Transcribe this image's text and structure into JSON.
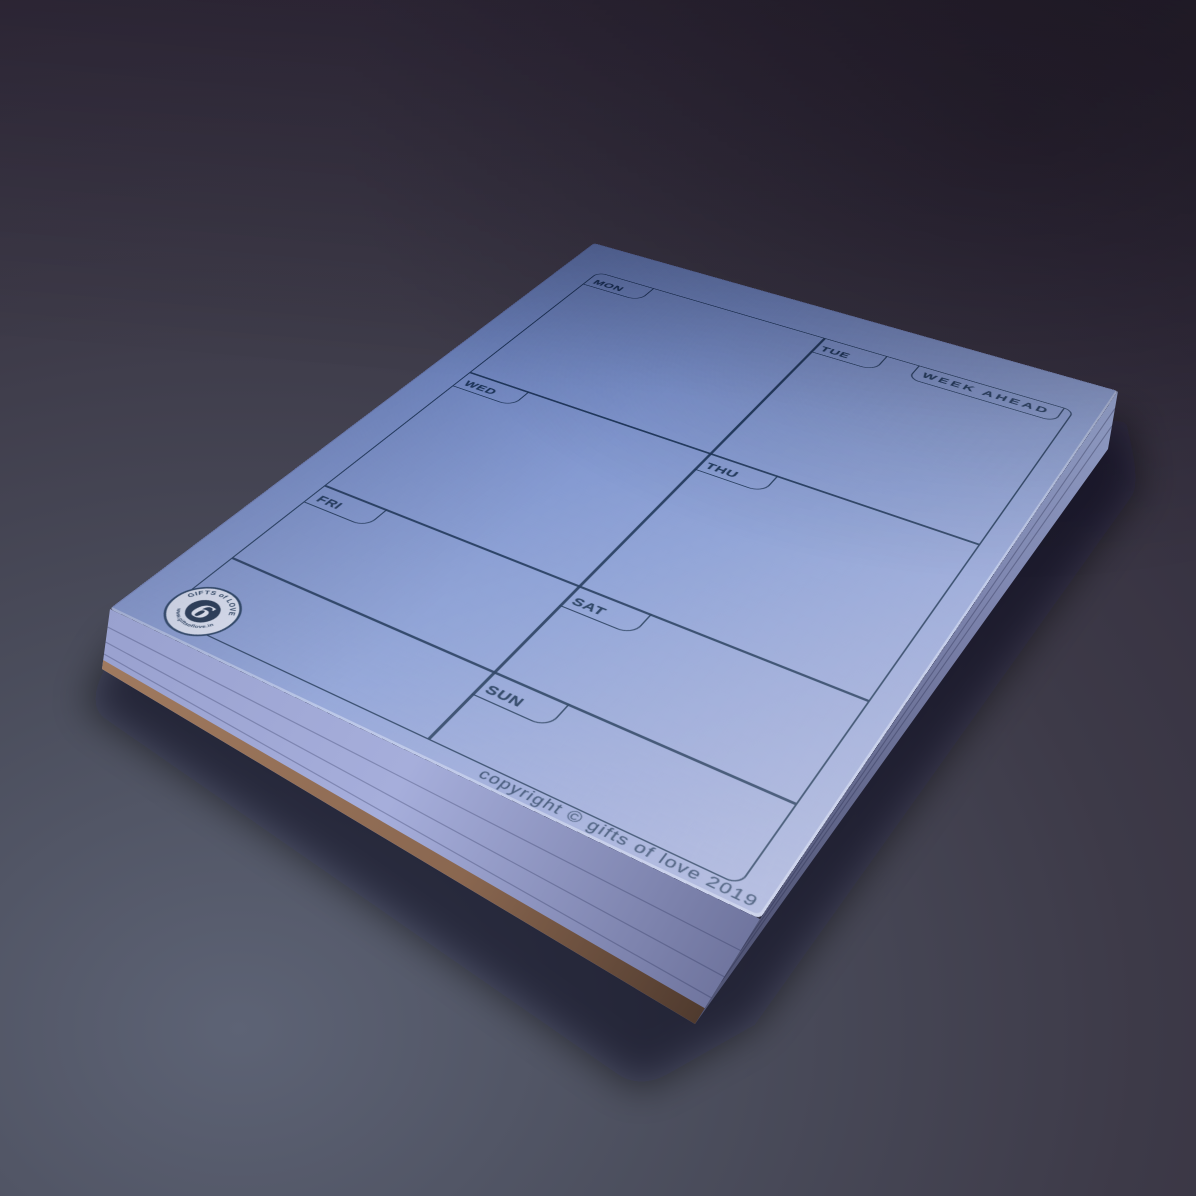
{
  "planner_pad": {
    "title": "WEEK AHEAD",
    "day_labels": {
      "mon": "MON",
      "tue": "TUE",
      "wed": "WED",
      "thu": "THU",
      "fri": "FRI",
      "sat": "SAT",
      "sun": "SUN"
    },
    "copyright_line": "copyright © gifts of love 2019",
    "brand_stamp": {
      "arc_top": "GIFTS of LOVE",
      "arc_bottom": "www.giftsoflove.in",
      "monogram": "6"
    }
  },
  "colors": {
    "paper_blue": "#7e94cf",
    "ink_navy": "#173155",
    "pad_side_lavender": "#9aa2d2",
    "backing_cardboard": "#96705a",
    "surface_top_plum": "#383140",
    "surface_bottom_slate": "#5c6274"
  }
}
